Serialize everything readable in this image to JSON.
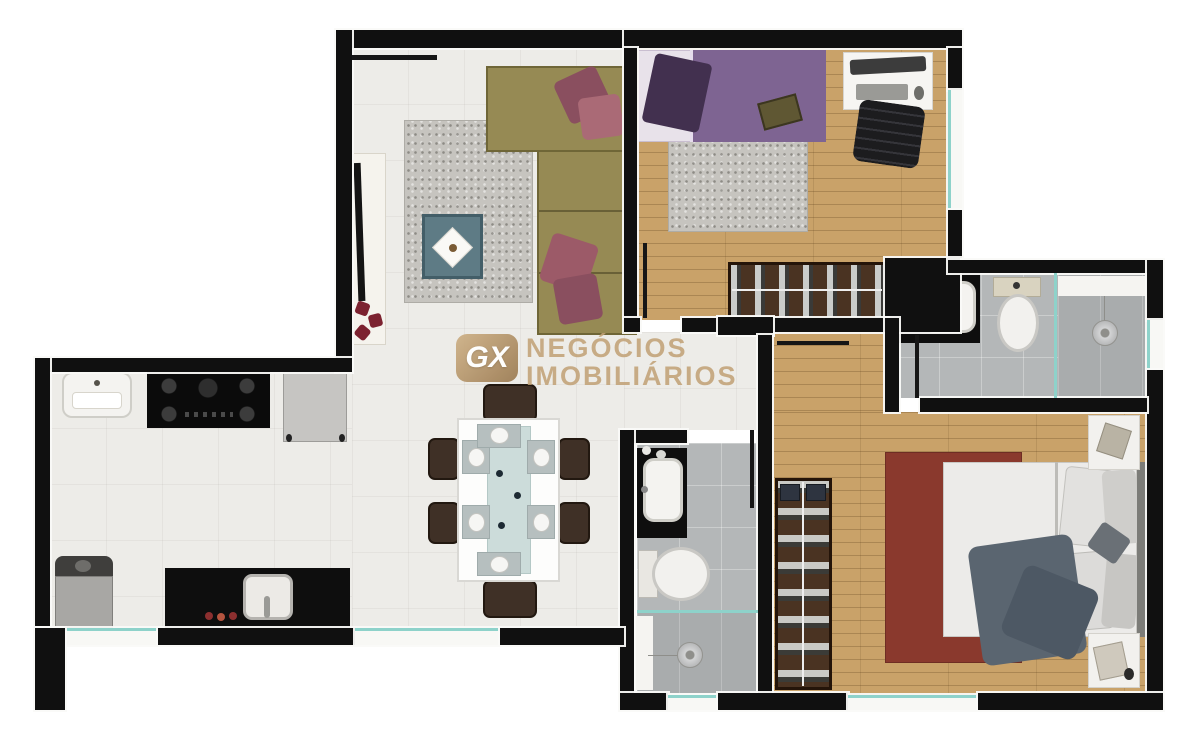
{
  "watermark": {
    "logo": "GX",
    "line1": "NEGÓCIOS",
    "line2": "IMOBILIÁRIOS"
  },
  "colors": {
    "wall": "#101010",
    "tile": "#edece8",
    "wood": "#c9a269",
    "bathtile": "#b4b7b8",
    "bathdark": "#a9acad",
    "glass": "#8ed2ca",
    "sofa": "#968a54",
    "pillowa": "#8a4f5f",
    "pillowb": "#aa6a76",
    "ruggray": "#c6c4bf",
    "rugred": "#8a392d",
    "quilt": "#7e6492",
    "bpillow": "#42304f",
    "teal": "#5e7b85",
    "ward": "#4a3322",
    "wardedge": "#241409",
    "counter": "#0e0e0e",
    "white": "#f4f3f0",
    "chair": "#3f3026",
    "washer": "#a8a7a4",
    "tan": "#c3a176"
  }
}
